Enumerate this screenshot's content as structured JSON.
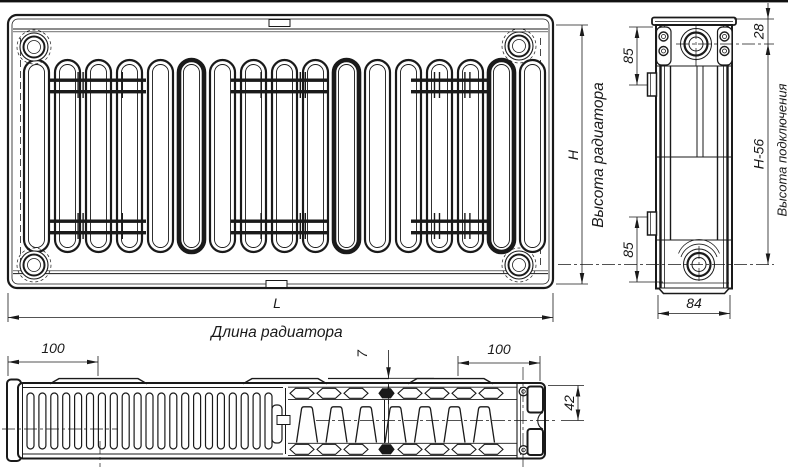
{
  "drawing": {
    "kind": "technical-drawing",
    "subject": "panel-radiator",
    "line_color": "#1a1a1a",
    "background_color": "#ffffff",
    "views": [
      "front",
      "side",
      "bottom"
    ]
  },
  "dimensions": {
    "length": {
      "symbol": "L",
      "caption": "Длина радиатора"
    },
    "height": {
      "symbol": "H",
      "caption": "Высота радиатора"
    },
    "connection_height": {
      "value": "H-56",
      "caption": "Высота подключения"
    },
    "top_port_offset": "28",
    "bracket_offset_top": "85",
    "bracket_offset_bottom": "85",
    "depth": "84",
    "bracket_inset_left": "100",
    "bracket_inset_right": "100",
    "panel_gap": "7",
    "half_depth": "42"
  }
}
